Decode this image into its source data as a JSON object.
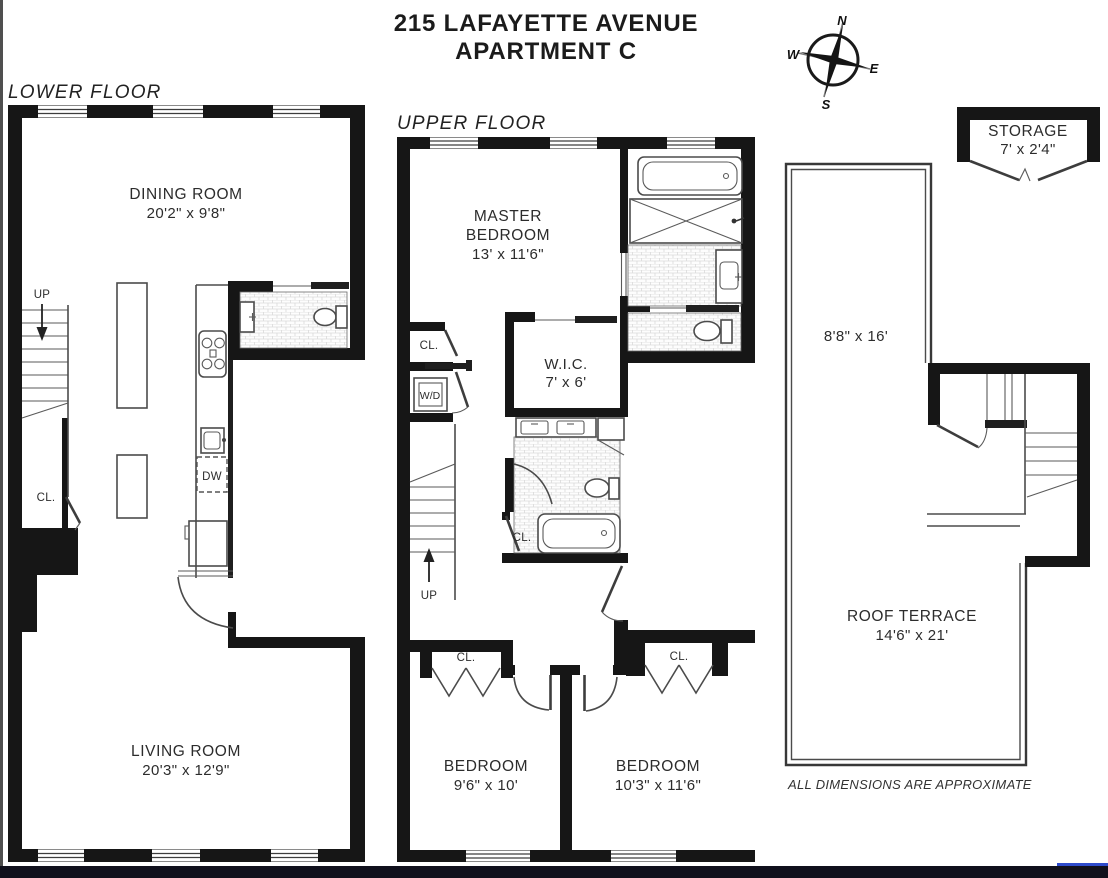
{
  "title": {
    "line1": "215 LAFAYETTE AVENUE",
    "line2": "APARTMENT C"
  },
  "compass": {
    "north": "N",
    "south": "S",
    "east": "E",
    "west": "W"
  },
  "lower_floor": {
    "label": "LOWER FLOOR",
    "dining_room": {
      "name": "DINING ROOM",
      "dims": "20'2\" x 9'8\""
    },
    "living_room": {
      "name": "LIVING ROOM",
      "dims": "20'3\" x 12'9\""
    }
  },
  "upper_floor": {
    "label": "UPPER FLOOR",
    "master_bedroom": {
      "name_line1": "MASTER",
      "name_line2": "BEDROOM",
      "dims": "13' x 11'6\""
    },
    "wic": {
      "name": "W.I.C.",
      "dims": "7' x 6'"
    },
    "bedroom_left": {
      "name": "BEDROOM",
      "dims": "9'6\" x 10'"
    },
    "bedroom_right": {
      "name": "BEDROOM",
      "dims": "10'3\" x 11'6\""
    }
  },
  "roof": {
    "storage": {
      "name": "STORAGE",
      "dims": "7' x 2'4\""
    },
    "upper_section_dims": "8'8\" x 16'",
    "terrace": {
      "name": "ROOF TERRACE",
      "dims": "14'6\" x 21'"
    }
  },
  "labels": {
    "closet": "CL.",
    "up": "UP",
    "washer_dryer": "W/D",
    "dishwasher": "DW"
  },
  "footnote": "ALL DIMENSIONS ARE APPROXIMATE",
  "colors": {
    "wall": "#161616",
    "background": "#ffffff",
    "bottom_bar": "#10101c"
  }
}
